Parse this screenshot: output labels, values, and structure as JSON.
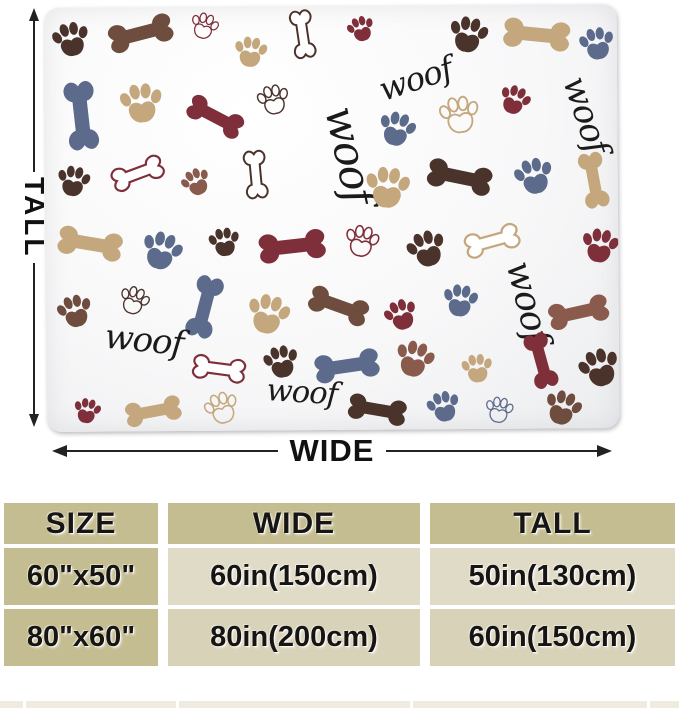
{
  "blanket": {
    "woof_text": "woof",
    "pattern_colors": {
      "darkBrown": "#4a332b",
      "brown": "#6e4c3e",
      "redBrown": "#8a5a4c",
      "tan": "#c4a77d",
      "maroon": "#7e2f3a",
      "slateBlue": "#5c6a8b",
      "ink": "#1b1b1b"
    },
    "pattern": [
      {
        "m": "paw",
        "c": "darkBrown",
        "x": 26,
        "y": 30,
        "s": 0.95,
        "r": -12
      },
      {
        "m": "bone",
        "c": "brown",
        "x": 96,
        "y": 26,
        "s": 1.5,
        "r": -14
      },
      {
        "m": "paw-o",
        "c": "maroon",
        "x": 160,
        "y": 18,
        "s": 0.7,
        "r": 18
      },
      {
        "m": "paw",
        "c": "tan",
        "x": 206,
        "y": 44,
        "s": 0.85,
        "r": 8
      },
      {
        "m": "bone-o",
        "c": "darkBrown",
        "x": 258,
        "y": 28,
        "s": 1.1,
        "r": 82
      },
      {
        "m": "paw",
        "c": "maroon",
        "x": 316,
        "y": 22,
        "s": 0.7,
        "r": -18
      },
      {
        "m": "woof",
        "c": "ink",
        "x": 374,
        "y": 84,
        "s": 0.95,
        "r": -18
      },
      {
        "m": "paw",
        "c": "darkBrown",
        "x": 424,
        "y": 28,
        "s": 1.0,
        "r": 12
      },
      {
        "m": "bone",
        "c": "tan",
        "x": 492,
        "y": 30,
        "s": 1.55,
        "r": 6
      },
      {
        "m": "paw",
        "c": "slateBlue",
        "x": 552,
        "y": 38,
        "s": 0.9,
        "r": -10
      },
      {
        "m": "bone",
        "c": "slateBlue",
        "x": 36,
        "y": 108,
        "s": 1.6,
        "r": 84
      },
      {
        "m": "paw",
        "c": "tan",
        "x": 96,
        "y": 94,
        "s": 1.1,
        "r": -6
      },
      {
        "m": "bone",
        "c": "maroon",
        "x": 170,
        "y": 110,
        "s": 1.35,
        "r": 28
      },
      {
        "m": "paw-o",
        "c": "darkBrown",
        "x": 228,
        "y": 92,
        "s": 0.8,
        "r": -12
      },
      {
        "m": "woof",
        "c": "ink",
        "x": 290,
        "y": 152,
        "s": 1.25,
        "r": 78
      },
      {
        "m": "paw",
        "c": "slateBlue",
        "x": 352,
        "y": 122,
        "s": 0.95,
        "r": 16
      },
      {
        "m": "paw-o",
        "c": "tan",
        "x": 414,
        "y": 108,
        "s": 1.0,
        "r": -8
      },
      {
        "m": "paw",
        "c": "maroon",
        "x": 470,
        "y": 94,
        "s": 0.8,
        "r": 22
      },
      {
        "m": "woof",
        "c": "ink",
        "x": 530,
        "y": 114,
        "s": 1.0,
        "r": 72
      },
      {
        "m": "paw",
        "c": "darkBrown",
        "x": 28,
        "y": 172,
        "s": 0.85,
        "r": 10
      },
      {
        "m": "bone-o",
        "c": "maroon",
        "x": 92,
        "y": 166,
        "s": 1.2,
        "r": -20
      },
      {
        "m": "paw",
        "c": "redBrown",
        "x": 150,
        "y": 174,
        "s": 0.75,
        "r": -25
      },
      {
        "m": "bone-o",
        "c": "darkBrown",
        "x": 210,
        "y": 168,
        "s": 1.1,
        "r": 85
      },
      {
        "m": "paw",
        "c": "tan",
        "x": 342,
        "y": 180,
        "s": 1.15,
        "r": 6
      },
      {
        "m": "bone",
        "c": "darkBrown",
        "x": 414,
        "y": 172,
        "s": 1.5,
        "r": 12
      },
      {
        "m": "paw",
        "c": "slateBlue",
        "x": 488,
        "y": 170,
        "s": 1.0,
        "r": -14
      },
      {
        "m": "bone",
        "c": "tan",
        "x": 548,
        "y": 176,
        "s": 1.3,
        "r": 80
      },
      {
        "m": "bone",
        "c": "tan",
        "x": 44,
        "y": 236,
        "s": 1.5,
        "r": 10
      },
      {
        "m": "paw",
        "c": "slateBlue",
        "x": 116,
        "y": 242,
        "s": 1.05,
        "r": 18
      },
      {
        "m": "paw",
        "c": "darkBrown",
        "x": 178,
        "y": 234,
        "s": 0.8,
        "r": -8
      },
      {
        "m": "bone",
        "c": "maroon",
        "x": 246,
        "y": 240,
        "s": 1.55,
        "r": -6
      },
      {
        "m": "paw-o",
        "c": "maroon",
        "x": 316,
        "y": 234,
        "s": 0.85,
        "r": 12
      },
      {
        "m": "paw",
        "c": "darkBrown",
        "x": 380,
        "y": 242,
        "s": 1.0,
        "r": -18
      },
      {
        "m": "bone-o",
        "c": "tan",
        "x": 446,
        "y": 236,
        "s": 1.25,
        "r": -15
      },
      {
        "m": "paw",
        "c": "maroon",
        "x": 554,
        "y": 240,
        "s": 0.95,
        "r": 10
      },
      {
        "m": "woof",
        "c": "ink",
        "x": 470,
        "y": 300,
        "s": 1.05,
        "r": 76
      },
      {
        "m": "paw",
        "c": "brown",
        "x": 28,
        "y": 302,
        "s": 0.9,
        "r": -15
      },
      {
        "m": "paw-o",
        "c": "darkBrown",
        "x": 88,
        "y": 292,
        "s": 0.75,
        "r": 20
      },
      {
        "m": "bone",
        "c": "slateBlue",
        "x": 158,
        "y": 300,
        "s": 1.45,
        "r": -75
      },
      {
        "m": "paw",
        "c": "tan",
        "x": 222,
        "y": 306,
        "s": 1.1,
        "r": 14
      },
      {
        "m": "bone",
        "c": "brown",
        "x": 292,
        "y": 300,
        "s": 1.4,
        "r": 20
      },
      {
        "m": "paw",
        "c": "maroon",
        "x": 354,
        "y": 308,
        "s": 0.85,
        "r": -20
      },
      {
        "m": "paw",
        "c": "slateBlue",
        "x": 414,
        "y": 294,
        "s": 0.9,
        "r": 8
      },
      {
        "m": "bone",
        "c": "redBrown",
        "x": 532,
        "y": 308,
        "s": 1.4,
        "r": -12
      },
      {
        "m": "woof",
        "c": "ink",
        "x": 96,
        "y": 344,
        "s": 1.0,
        "r": 6
      },
      {
        "m": "bone-o",
        "c": "maroon",
        "x": 172,
        "y": 362,
        "s": 1.2,
        "r": 8
      },
      {
        "m": "paw",
        "c": "darkBrown",
        "x": 234,
        "y": 354,
        "s": 0.9,
        "r": -12
      },
      {
        "m": "bone",
        "c": "slateBlue",
        "x": 300,
        "y": 360,
        "s": 1.5,
        "r": -8
      },
      {
        "m": "paw",
        "c": "redBrown",
        "x": 368,
        "y": 352,
        "s": 1.0,
        "r": 16
      },
      {
        "m": "paw",
        "c": "tan",
        "x": 430,
        "y": 362,
        "s": 0.8,
        "r": -6
      },
      {
        "m": "bone",
        "c": "maroon",
        "x": 494,
        "y": 356,
        "s": 1.3,
        "r": 75
      },
      {
        "m": "paw",
        "c": "darkBrown",
        "x": 552,
        "y": 362,
        "s": 1.05,
        "r": -18
      },
      {
        "m": "paw",
        "c": "maroon",
        "x": 40,
        "y": 402,
        "s": 0.7,
        "r": 12
      },
      {
        "m": "bone",
        "c": "tan",
        "x": 106,
        "y": 404,
        "s": 1.3,
        "r": -10
      },
      {
        "m": "paw-o",
        "c": "tan",
        "x": 174,
        "y": 400,
        "s": 0.85,
        "r": -18
      },
      {
        "m": "woof",
        "c": "ink",
        "x": 254,
        "y": 396,
        "s": 0.9,
        "r": 4
      },
      {
        "m": "bone",
        "c": "darkBrown",
        "x": 330,
        "y": 404,
        "s": 1.35,
        "r": 10
      },
      {
        "m": "paw",
        "c": "slateBlue",
        "x": 396,
        "y": 400,
        "s": 0.85,
        "r": -14
      },
      {
        "m": "paw-o",
        "c": "slateBlue",
        "x": 452,
        "y": 404,
        "s": 0.7,
        "r": 10
      },
      {
        "m": "paw",
        "c": "brown",
        "x": 516,
        "y": 402,
        "s": 0.95,
        "r": 18
      }
    ]
  },
  "dimensions": {
    "tall_label": "TALL",
    "wide_label": "WIDE"
  },
  "size_chart": {
    "headers": [
      "SIZE",
      "WIDE",
      "TALL"
    ],
    "rows": [
      [
        "60\"x50\"",
        "60in(150cm)",
        "50in(130cm)"
      ],
      [
        "80\"x60\"",
        "80in(200cm)",
        "60in(150cm)"
      ]
    ],
    "header_bg": "#c5bd92",
    "row_bg_light": "#e0dbc7",
    "row_bg_mid": "#d8d2b9"
  }
}
